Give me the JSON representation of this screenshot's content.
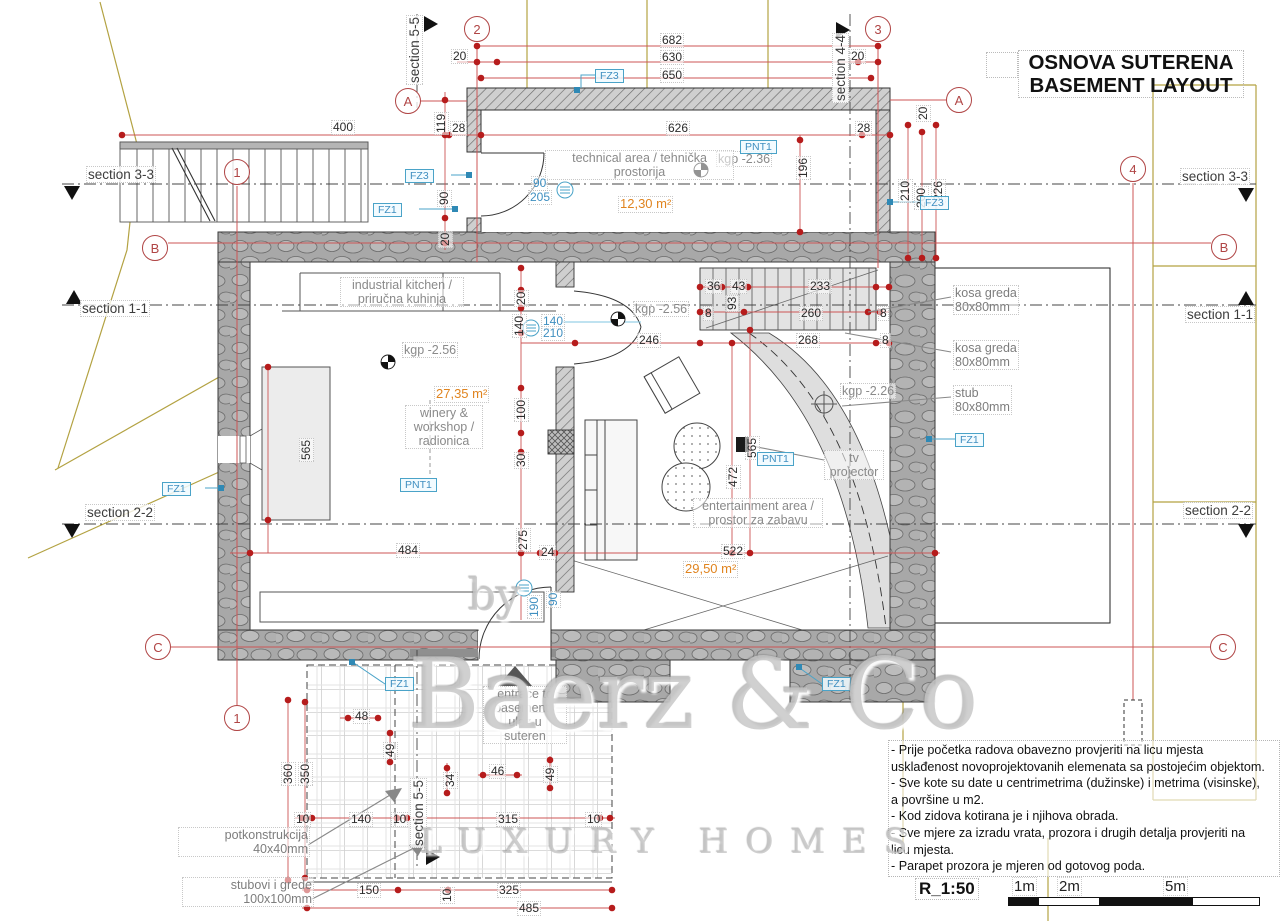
{
  "title": {
    "line1": "OSNOVA SUTERENA",
    "line2": "BASEMENT LAYOUT"
  },
  "scale": {
    "label": "R_1:50",
    "marks": [
      "1m",
      "2m",
      "5m"
    ]
  },
  "watermark": {
    "by": "by",
    "name": "Baerz & Co",
    "tagline": "LUXURY HOMES"
  },
  "colors": {
    "dimension_red": "#cc5555",
    "marker_red": "#b61c1c",
    "bubble_red": "#b04545",
    "tag_blue": "#4aa3c8",
    "area_orange": "#e0841f",
    "terrain_olive": "#b3a242",
    "label_gray": "#8a8a8a"
  },
  "notes": {
    "lines": [
      "- Prije početka radova obavezno provjeriti na licu mjesta",
      "usklađenost novoprojektovanih elemenata sa postojećim objektom.",
      "- Sve kote su date u centrimetrima (dužinske) i metrima (visinske),",
      "a površine u m2.",
      "- Kod zidova kotirana je i njihova obrada.",
      "- Sve mjere za izradu vrata, prozora i drugih detalja provjeriti na",
      "licu mjesta.",
      "- Parapet prozora je mjeren od gotovog poda."
    ]
  },
  "bubbles": [
    {
      "t": "1",
      "x": 237,
      "y": 172
    },
    {
      "t": "1",
      "x": 237,
      "y": 718
    },
    {
      "t": "2",
      "x": 477,
      "y": 29
    },
    {
      "t": "3",
      "x": 878,
      "y": 29
    },
    {
      "t": "4",
      "x": 1133,
      "y": 169
    },
    {
      "t": "A",
      "x": 408,
      "y": 101
    },
    {
      "t": "A",
      "x": 959,
      "y": 100
    },
    {
      "t": "B",
      "x": 155,
      "y": 248
    },
    {
      "t": "B",
      "x": 1224,
      "y": 247
    },
    {
      "t": "C",
      "x": 158,
      "y": 647
    },
    {
      "t": "C",
      "x": 1223,
      "y": 647
    }
  ],
  "tags": [
    {
      "t": "FZ3",
      "x": 595,
      "y": 69
    },
    {
      "t": "FZ3",
      "x": 405,
      "y": 169
    },
    {
      "t": "FZ1",
      "x": 373,
      "y": 203
    },
    {
      "t": "FZ3",
      "x": 920,
      "y": 196
    },
    {
      "t": "FZ1",
      "x": 162,
      "y": 482
    },
    {
      "t": "FZ1",
      "x": 955,
      "y": 433
    },
    {
      "t": "FZ1",
      "x": 385,
      "y": 677
    },
    {
      "t": "FZ1",
      "x": 822,
      "y": 677
    },
    {
      "t": "PNT1",
      "x": 740,
      "y": 140
    },
    {
      "t": "PNT1",
      "x": 400,
      "y": 478
    },
    {
      "t": "PNT1",
      "x": 757,
      "y": 452
    }
  ],
  "texts": [
    {
      "t": "682",
      "x": 660,
      "y": 33
    },
    {
      "t": "630",
      "x": 660,
      "y": 50
    },
    {
      "t": "650",
      "x": 660,
      "y": 68
    },
    {
      "t": "20",
      "x": 451,
      "y": 49
    },
    {
      "t": "20",
      "x": 849,
      "y": 49
    },
    {
      "t": "626",
      "x": 666,
      "y": 121
    },
    {
      "t": "28",
      "x": 450,
      "y": 121
    },
    {
      "t": "28",
      "x": 855,
      "y": 121
    },
    {
      "t": "400",
      "x": 331,
      "y": 120
    },
    {
      "t": "119",
      "x": 434,
      "y": 135,
      "cls": "rot"
    },
    {
      "t": "90",
      "x": 437,
      "y": 207,
      "cls": "rot"
    },
    {
      "t": "20",
      "x": 438,
      "y": 248,
      "cls": "rot"
    },
    {
      "t": "196",
      "x": 796,
      "y": 180,
      "cls": "rot"
    },
    {
      "t": "210",
      "x": 898,
      "y": 203,
      "cls": "rot"
    },
    {
      "t": "200",
      "x": 914,
      "y": 210,
      "cls": "rot"
    },
    {
      "t": "226",
      "x": 931,
      "y": 203,
      "cls": "rot"
    },
    {
      "t": "20",
      "x": 916,
      "y": 122,
      "cls": "rot"
    },
    {
      "t": "90",
      "x": 531,
      "y": 176,
      "cls": "b"
    },
    {
      "t": "205",
      "x": 528,
      "y": 190,
      "cls": "b"
    },
    {
      "t": "140",
      "x": 541,
      "y": 314,
      "cls": "b"
    },
    {
      "t": "210",
      "x": 541,
      "y": 326,
      "cls": "b"
    },
    {
      "t": "90",
      "x": 546,
      "y": 608,
      "cls": "rot b"
    },
    {
      "t": "190",
      "x": 527,
      "y": 619,
      "cls": "rot b"
    },
    {
      "t": "20",
      "x": 514,
      "y": 307,
      "cls": "rot"
    },
    {
      "t": "140",
      "x": 512,
      "y": 338,
      "cls": "rot"
    },
    {
      "t": "100",
      "x": 514,
      "y": 422,
      "cls": "rot"
    },
    {
      "t": "30",
      "x": 514,
      "y": 469,
      "cls": "rot"
    },
    {
      "t": "275",
      "x": 516,
      "y": 552,
      "cls": "rot"
    },
    {
      "t": "246",
      "x": 637,
      "y": 333
    },
    {
      "t": "268",
      "x": 796,
      "y": 333
    },
    {
      "t": "8",
      "x": 880,
      "y": 333
    },
    {
      "t": "36",
      "x": 705,
      "y": 279
    },
    {
      "t": "43",
      "x": 730,
      "y": 279
    },
    {
      "t": "233",
      "x": 808,
      "y": 279
    },
    {
      "t": "93",
      "x": 725,
      "y": 312,
      "cls": "rot"
    },
    {
      "t": "8",
      "x": 703,
      "y": 306
    },
    {
      "t": "260",
      "x": 799,
      "y": 306
    },
    {
      "t": "8",
      "x": 878,
      "y": 306
    },
    {
      "t": "565",
      "x": 299,
      "y": 462,
      "cls": "rot"
    },
    {
      "t": "565",
      "x": 745,
      "y": 460,
      "cls": "rot"
    },
    {
      "t": "472",
      "x": 726,
      "y": 489,
      "cls": "rot"
    },
    {
      "t": "484",
      "x": 396,
      "y": 543
    },
    {
      "t": "24",
      "x": 539,
      "y": 545
    },
    {
      "t": "522",
      "x": 721,
      "y": 544
    },
    {
      "t": "48",
      "x": 353,
      "y": 709
    },
    {
      "t": "49",
      "x": 383,
      "y": 759,
      "cls": "rot"
    },
    {
      "t": "34",
      "x": 443,
      "y": 789,
      "cls": "rot"
    },
    {
      "t": "46",
      "x": 489,
      "y": 764
    },
    {
      "t": "49",
      "x": 543,
      "y": 783,
      "cls": "rot"
    },
    {
      "t": "360",
      "x": 281,
      "y": 786,
      "cls": "rot"
    },
    {
      "t": "350",
      "x": 298,
      "y": 786,
      "cls": "rot"
    },
    {
      "t": "10",
      "x": 294,
      "y": 812
    },
    {
      "t": "140",
      "x": 349,
      "y": 812
    },
    {
      "t": "10",
      "x": 391,
      "y": 812
    },
    {
      "t": "315",
      "x": 496,
      "y": 812
    },
    {
      "t": "10",
      "x": 585,
      "y": 812
    },
    {
      "t": "150",
      "x": 357,
      "y": 883
    },
    {
      "t": "10",
      "x": 440,
      "y": 904,
      "cls": "rot"
    },
    {
      "t": "325",
      "x": 497,
      "y": 883
    },
    {
      "t": "485",
      "x": 517,
      "y": 901
    },
    {
      "t": "12,30 m²",
      "x": 618,
      "y": 196,
      "cls": "o"
    },
    {
      "t": "27,35 m²",
      "x": 434,
      "y": 386,
      "cls": "o"
    },
    {
      "t": "29,50 m²",
      "x": 683,
      "y": 561,
      "cls": "o"
    },
    {
      "t": "kgp -2.36",
      "x": 716,
      "y": 151,
      "cls": "k"
    },
    {
      "t": "kgp -2.56",
      "x": 402,
      "y": 342,
      "cls": "k"
    },
    {
      "t": "kgp -2.56",
      "x": 633,
      "y": 301,
      "cls": "k"
    },
    {
      "t": "kgp -2.26",
      "x": 840,
      "y": 383,
      "cls": "k"
    },
    {
      "t": "technical area / tehnička\nprostorija",
      "x": 545,
      "y": 150,
      "w": 185,
      "cls": "g",
      "n": "room-label-technical"
    },
    {
      "t": "industrial kitchen /\npriručna kuhinja",
      "x": 340,
      "y": 277,
      "w": 120,
      "cls": "g",
      "n": "room-label-kitchen"
    },
    {
      "t": "winery &\nworkshop /\nradionica",
      "x": 405,
      "y": 405,
      "w": 74,
      "cls": "g",
      "n": "room-label-winery"
    },
    {
      "t": "entertainment area /\nprostor za zabavu",
      "x": 693,
      "y": 498,
      "w": 126,
      "cls": "g",
      "n": "room-label-entertainment"
    },
    {
      "t": "tv\nprojector",
      "x": 824,
      "y": 450,
      "w": 56,
      "cls": "g",
      "n": "tv-projector-label"
    },
    {
      "t": "entrace to\nbasement /\nulaz u\nsuteren",
      "x": 483,
      "y": 686,
      "w": 80,
      "cls": "g",
      "n": "entrance-label"
    },
    {
      "t": "kosa greda\n80x80mm",
      "x": 953,
      "y": 285,
      "cls": "ann"
    },
    {
      "t": "kosa greda\n80x80mm",
      "x": 953,
      "y": 340,
      "cls": "ann"
    },
    {
      "t": "stub\n80x80mm",
      "x": 953,
      "y": 385,
      "cls": "ann"
    },
    {
      "t": "potkonstrukcija\n40x40mm",
      "x": 178,
      "y": 827,
      "w": 128,
      "cls": "ann annr"
    },
    {
      "t": "stubovi i grede\n100x100mm",
      "x": 182,
      "y": 877,
      "w": 128,
      "cls": "ann annr"
    },
    {
      "t": "section 3-3",
      "x": 86,
      "y": 166,
      "cls": "sec"
    },
    {
      "t": "section 3-3",
      "x": 1180,
      "y": 168,
      "cls": "sec"
    },
    {
      "t": "section 1-1",
      "x": 80,
      "y": 300,
      "cls": "sec"
    },
    {
      "t": "section 1-1",
      "x": 1185,
      "y": 306,
      "cls": "sec"
    },
    {
      "t": "section 2-2",
      "x": 85,
      "y": 504,
      "cls": "sec"
    },
    {
      "t": "section 2-2",
      "x": 1183,
      "y": 502,
      "cls": "sec"
    },
    {
      "t": "section 4-4",
      "x": 832,
      "y": 103,
      "cls": "rot sec"
    },
    {
      "t": "section 5-5",
      "x": 406,
      "y": 85,
      "cls": "rot sec"
    },
    {
      "t": "section 5-5",
      "x": 410,
      "y": 848,
      "cls": "rot sec"
    }
  ]
}
